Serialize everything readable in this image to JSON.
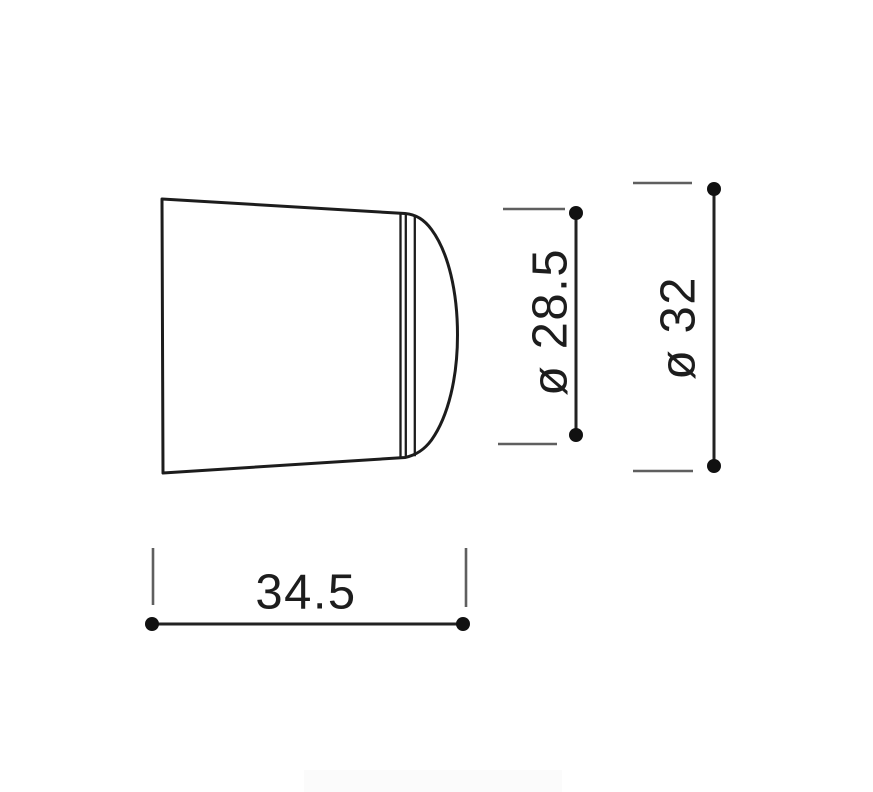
{
  "diagram": {
    "labels": {
      "width": "34.5",
      "head_diameter": "ø 28.5",
      "base_diameter": "ø 32"
    },
    "values": {
      "width": 34.5,
      "head_diameter": 28.5,
      "base_diameter": 32
    },
    "colors": {
      "outline": "#1c1c1c",
      "dimension_line": "#222222",
      "extension_tick": "#5f5f5f",
      "endpoint_dot": "#111111",
      "text": "#1d1d1d",
      "background": "#ffffff",
      "watermark_band": "#fbfbfb"
    }
  }
}
